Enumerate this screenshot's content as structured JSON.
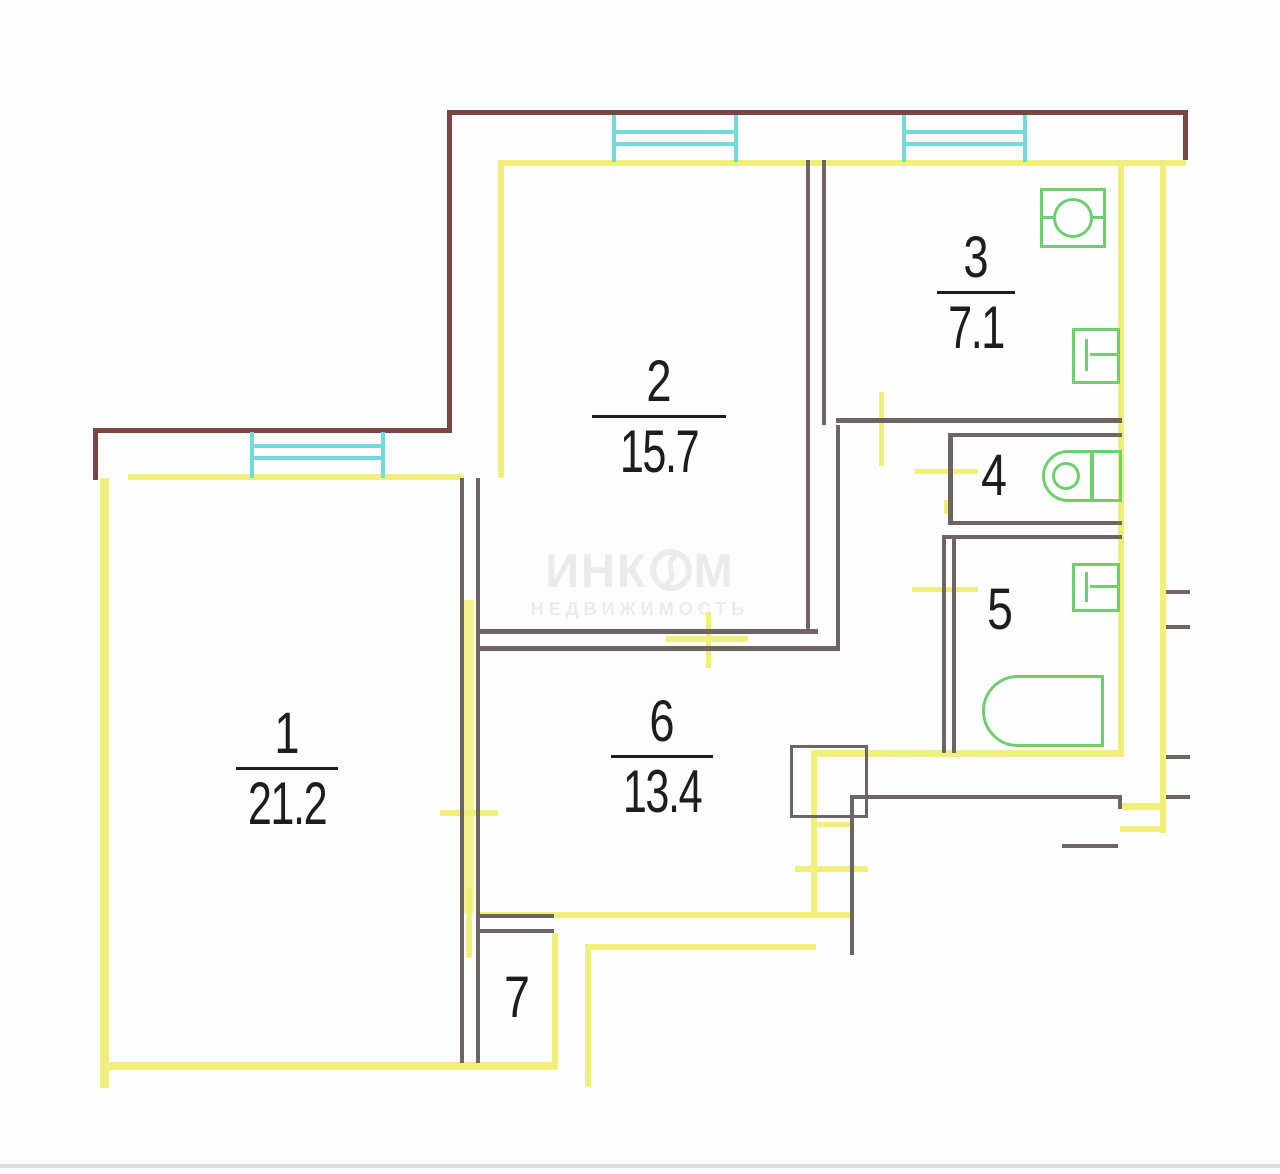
{
  "document": {
    "type": "apartment-floor-plan",
    "watermark": {
      "brand_left": "ИНК",
      "brand_right": "М",
      "subtitle": "НЕДВИЖИМОСТЬ"
    }
  },
  "rooms": {
    "r1": {
      "number": "1",
      "area": "21.2"
    },
    "r2": {
      "number": "2",
      "area": "15.7"
    },
    "r3": {
      "number": "3",
      "area": "7.1"
    },
    "r4": {
      "number": "4"
    },
    "r5": {
      "number": "5"
    },
    "r6": {
      "number": "6",
      "area": "13.4"
    },
    "r7": {
      "number": "7"
    }
  },
  "fixtures": [
    "stove-icon",
    "kitchen-sink-icon",
    "toilet-icon",
    "wash-basin-icon",
    "bathtub-icon"
  ],
  "windows_count": 3,
  "colors": {
    "exterior_wall": "#7c4545",
    "interior_wall": "#f0ef7c",
    "partition_wall": "#6e6464",
    "window": "#74d9db",
    "fixture": "#6fcf6f",
    "label": "#1d1d1d",
    "watermark": "#ebebeb"
  }
}
